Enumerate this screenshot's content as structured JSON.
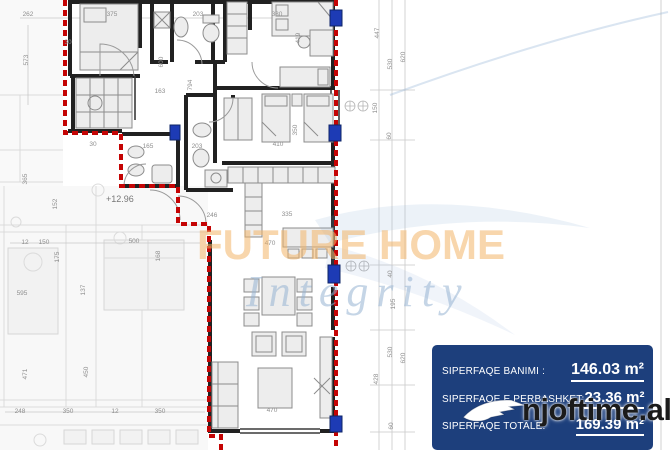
{
  "watermarks": {
    "brand": "FUTURE HOME",
    "tagline": "Integrity",
    "site": "njoftime.al"
  },
  "level_label": "+12.96",
  "info_box": {
    "bg_color": "#1d3f7c",
    "text_color": "#ffffff",
    "rows": [
      {
        "label": "SIPERFAQE BANIMI :",
        "value": "146.03 m²"
      },
      {
        "label": "SIPERFAQE E PERBASHKET:",
        "value": "23.36 m²"
      },
      {
        "label": "SIPERFAQE TOTALE:",
        "value": "169.39 m²"
      }
    ]
  },
  "colors": {
    "boundary_red": "#c40404",
    "window_blue": "#1d3bb5",
    "wall_black": "#212121",
    "watermark_orange": "rgba(243,181,104,0.55)",
    "watermark_blue": "rgba(150,178,210,0.55)"
  },
  "dimension_labels": [
    {
      "t": "262",
      "x": 28,
      "y": 16,
      "r": 0
    },
    {
      "t": "375",
      "x": 112,
      "y": 16,
      "r": 0
    },
    {
      "t": "203",
      "x": 198,
      "y": 16,
      "r": 0
    },
    {
      "t": "380",
      "x": 277,
      "y": 16,
      "r": 0
    },
    {
      "t": "30",
      "x": 68,
      "y": 44,
      "r": 0
    },
    {
      "t": "573",
      "x": 28,
      "y": 60,
      "r": -90
    },
    {
      "t": "600",
      "x": 163,
      "y": 62,
      "r": -90
    },
    {
      "t": "794",
      "x": 192,
      "y": 85,
      "r": -90
    },
    {
      "t": "163",
      "x": 160,
      "y": 93,
      "r": 0
    },
    {
      "t": "419",
      "x": 300,
      "y": 38,
      "r": -90
    },
    {
      "t": "447",
      "x": 379,
      "y": 33,
      "r": -90
    },
    {
      "t": "530",
      "x": 392,
      "y": 64,
      "r": -90
    },
    {
      "t": "620",
      "x": 405,
      "y": 57,
      "r": -90
    },
    {
      "t": "350",
      "x": 297,
      "y": 130,
      "r": -90
    },
    {
      "t": "150",
      "x": 377,
      "y": 108,
      "r": -90
    },
    {
      "t": "60",
      "x": 391,
      "y": 136,
      "r": -90
    },
    {
      "t": "165",
      "x": 148,
      "y": 148,
      "r": 0
    },
    {
      "t": "203",
      "x": 197,
      "y": 148,
      "r": 0
    },
    {
      "t": "410",
      "x": 278,
      "y": 146,
      "r": 0
    },
    {
      "t": "30",
      "x": 93,
      "y": 146,
      "r": 0
    },
    {
      "t": "246",
      "x": 212,
      "y": 217,
      "r": 0
    },
    {
      "t": "335",
      "x": 287,
      "y": 216,
      "r": 0
    },
    {
      "t": "470",
      "x": 270,
      "y": 245,
      "r": 0
    },
    {
      "t": "365",
      "x": 27,
      "y": 179,
      "r": -90
    },
    {
      "t": "152",
      "x": 57,
      "y": 204,
      "r": -90
    },
    {
      "t": "12",
      "x": 25,
      "y": 244,
      "r": 0
    },
    {
      "t": "150",
      "x": 44,
      "y": 244,
      "r": 0
    },
    {
      "t": "500",
      "x": 134,
      "y": 243,
      "r": 0
    },
    {
      "t": "175",
      "x": 59,
      "y": 257,
      "r": -90
    },
    {
      "t": "137",
      "x": 85,
      "y": 290,
      "r": -90
    },
    {
      "t": "168",
      "x": 160,
      "y": 256,
      "r": -90
    },
    {
      "t": "595",
      "x": 22,
      "y": 295,
      "r": 0
    },
    {
      "t": "40",
      "x": 392,
      "y": 274,
      "r": -90
    },
    {
      "t": "195",
      "x": 395,
      "y": 304,
      "r": -90
    },
    {
      "t": "530",
      "x": 392,
      "y": 352,
      "r": -90
    },
    {
      "t": "620",
      "x": 405,
      "y": 358,
      "r": -90
    },
    {
      "t": "428",
      "x": 378,
      "y": 379,
      "r": -90
    },
    {
      "t": "471",
      "x": 27,
      "y": 374,
      "r": -90
    },
    {
      "t": "450",
      "x": 88,
      "y": 372,
      "r": -90
    },
    {
      "t": "248",
      "x": 20,
      "y": 413,
      "r": 0
    },
    {
      "t": "350",
      "x": 68,
      "y": 413,
      "r": 0
    },
    {
      "t": "12",
      "x": 115,
      "y": 413,
      "r": 0
    },
    {
      "t": "350",
      "x": 160,
      "y": 413,
      "r": 0
    },
    {
      "t": "470",
      "x": 272,
      "y": 412,
      "r": 0
    },
    {
      "t": "60",
      "x": 393,
      "y": 426,
      "r": -90
    }
  ]
}
